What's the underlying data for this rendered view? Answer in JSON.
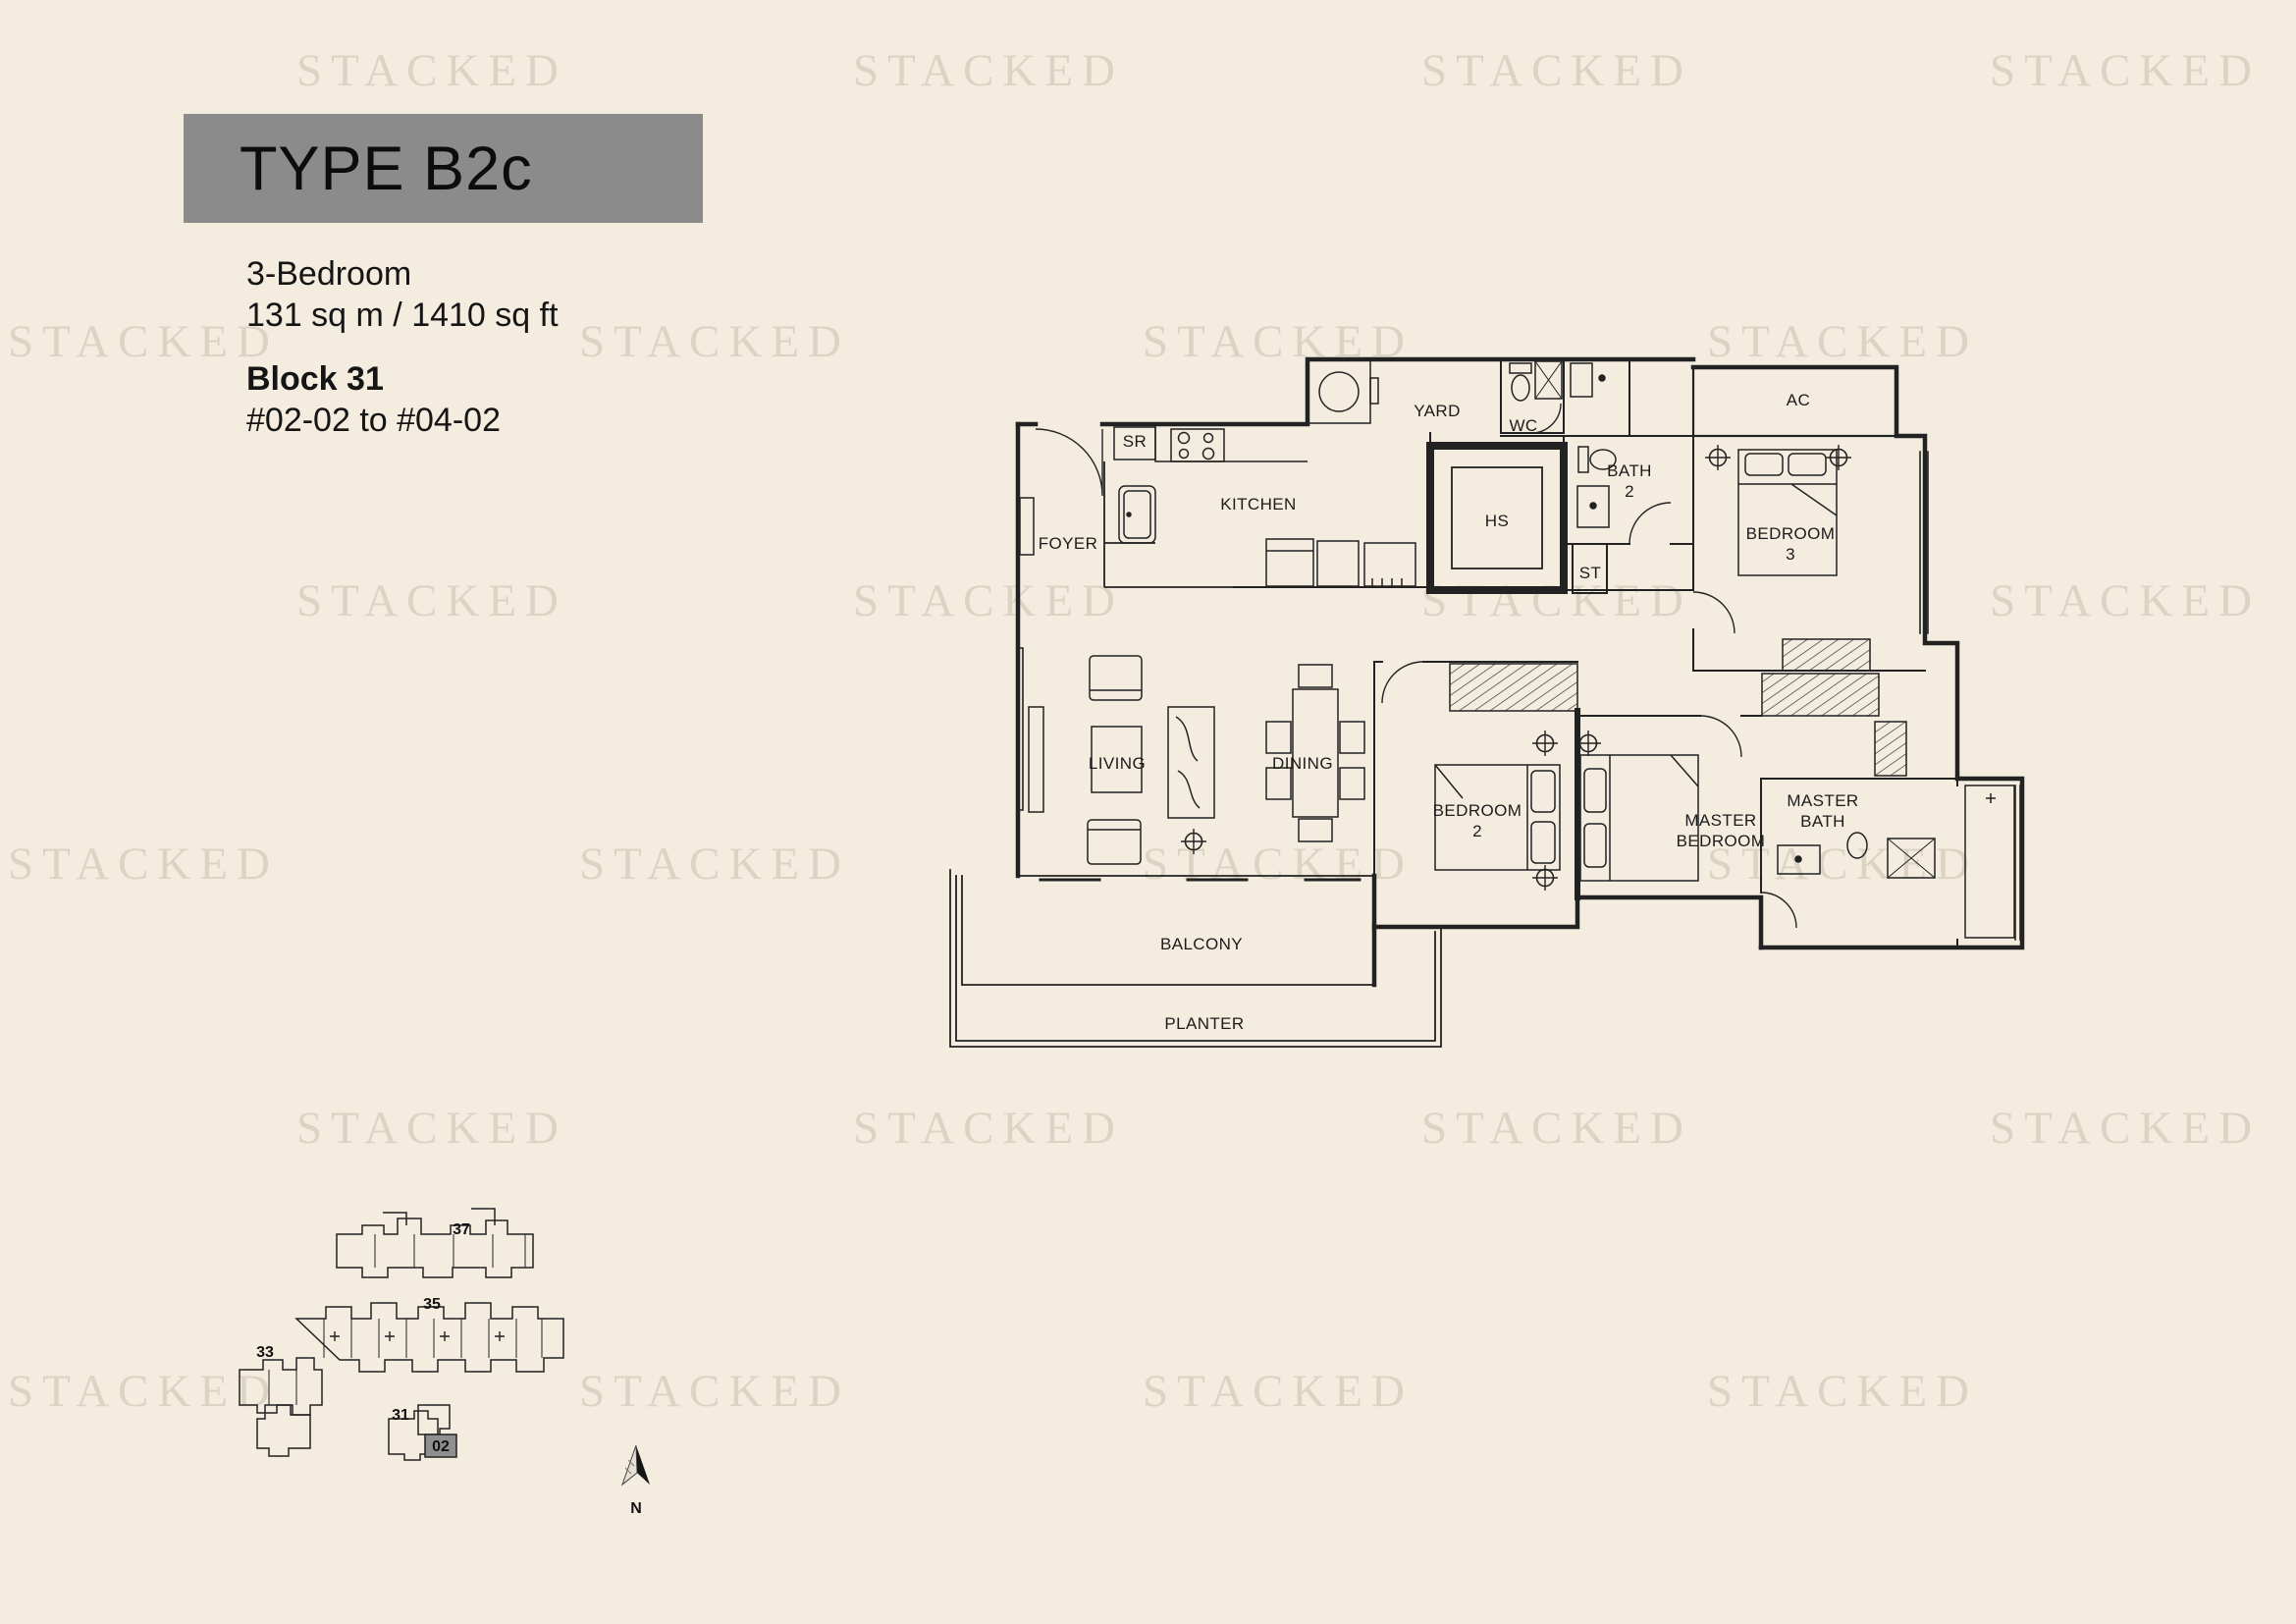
{
  "header": {
    "type_label": "TYPE B2c",
    "bedroom_line": "3-Bedroom",
    "area_line": "131 sq m / 1410 sq ft",
    "block_line": "Block 31",
    "units_line": "#02-02 to #04-02"
  },
  "watermark": {
    "text": "STACKED"
  },
  "floorplan": {
    "rooms": [
      {
        "id": "foyer",
        "label": "FOYER"
      },
      {
        "id": "kitchen",
        "label": "KITCHEN"
      },
      {
        "id": "sr",
        "label": "SR"
      },
      {
        "id": "yard",
        "label": "YARD"
      },
      {
        "id": "wc",
        "label": "WC"
      },
      {
        "id": "hs",
        "label": "HS"
      },
      {
        "id": "bath_2",
        "label": "BATH 2"
      },
      {
        "id": "st",
        "label": "ST"
      },
      {
        "id": "ac",
        "label": "AC"
      },
      {
        "id": "bedroom_3",
        "label": "BEDROOM 3"
      },
      {
        "id": "living",
        "label": "LIVING"
      },
      {
        "id": "dining",
        "label": "DINING"
      },
      {
        "id": "bedroom_2",
        "label": "BEDROOM 2"
      },
      {
        "id": "master_bedroom",
        "label": "MASTER BEDROOM"
      },
      {
        "id": "master_bath",
        "label": "MASTER BATH"
      },
      {
        "id": "balcony",
        "label": "BALCONY"
      },
      {
        "id": "planter",
        "label": "PLANTER"
      }
    ]
  },
  "siteplan": {
    "blocks": [
      {
        "id": "37",
        "label": "37"
      },
      {
        "id": "35",
        "label": "35"
      },
      {
        "id": "33",
        "label": "33"
      },
      {
        "id": "31",
        "label": "31"
      }
    ],
    "highlighted_unit": "02",
    "north_label": "N"
  }
}
